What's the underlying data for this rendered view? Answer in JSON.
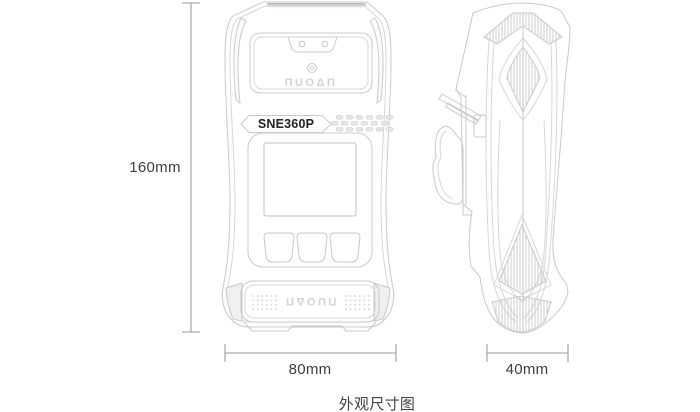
{
  "caption": "外观尺寸图",
  "dimensions": {
    "height": "160mm",
    "front_width": "80mm",
    "side_depth": "40mm"
  },
  "device": {
    "model": "SNE360P",
    "brand_logo": "ΠUOΔΠ"
  },
  "colors": {
    "line": "#c7cacb",
    "line_soft": "#d6d8d9",
    "dim_line": "#9a9a9a",
    "label_text": "#3d3d3d",
    "hatch": "#bfc3c4",
    "logo_gray": "#d2d5d6",
    "grille_fill": "#e4e6e7"
  }
}
